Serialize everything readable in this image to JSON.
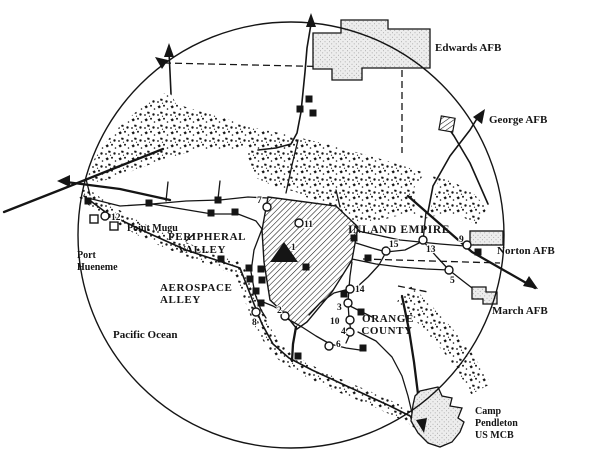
{
  "map": {
    "paper": "#ffffff",
    "ink": "#151515",
    "labels": {
      "edwards": "Edwards AFB",
      "george": "George AFB",
      "norton": "Norton AFB",
      "march": "March AFB",
      "pendleton1": "Camp",
      "pendleton2": "Pendleton",
      "pendleton3": "US MCB",
      "point_mugu": "Point Mugu",
      "port_hueneme1": "Port",
      "port_hueneme2": "Hueneme",
      "ocean": "Pacific Ocean",
      "peripheral1": "PERIPHERAL",
      "peripheral2": "VALLEY",
      "aerospace1": "AEROSPACE",
      "aerospace2": "ALLEY",
      "inland_empire": "INLAND EMPIRE",
      "orange1": "ORANGE",
      "orange2": "COUNTY"
    },
    "sites": [
      {
        "n": "1",
        "x": 284,
        "y": 253,
        "marker": "triangle",
        "lx": 291,
        "ly": 250
      },
      {
        "n": "2",
        "x": 285,
        "y": 316,
        "marker": "circle",
        "lx": 277,
        "ly": 313
      },
      {
        "n": "3",
        "x": 348,
        "y": 303,
        "marker": "circle",
        "lx": 337,
        "ly": 310
      },
      {
        "n": "4",
        "x": 350,
        "y": 332,
        "marker": "circle",
        "lx": 341,
        "ly": 334
      },
      {
        "n": "5",
        "x": 449,
        "y": 270,
        "marker": "circle",
        "lx": 450,
        "ly": 283
      },
      {
        "n": "6",
        "x": 329,
        "y": 346,
        "marker": "circle",
        "lx": 336,
        "ly": 347
      },
      {
        "n": "7",
        "x": 267,
        "y": 207,
        "marker": "circle",
        "lx": 257,
        "ly": 203
      },
      {
        "n": "8",
        "x": 256,
        "y": 312,
        "marker": "circle",
        "lx": 252,
        "ly": 325
      },
      {
        "n": "9",
        "x": 467,
        "y": 245,
        "marker": "circle",
        "lx": 459,
        "ly": 242
      },
      {
        "n": "10",
        "x": 350,
        "y": 320,
        "marker": "circle",
        "lx": 330,
        "ly": 324
      },
      {
        "n": "11",
        "x": 299,
        "y": 223,
        "marker": "circle",
        "lx": 304,
        "ly": 227
      },
      {
        "n": "12",
        "x": 105,
        "y": 216,
        "marker": "circle",
        "lx": 111,
        "ly": 220
      },
      {
        "n": "13",
        "x": 423,
        "y": 240,
        "marker": "circle",
        "lx": 426,
        "ly": 252
      },
      {
        "n": "14",
        "x": 350,
        "y": 289,
        "marker": "circle",
        "lx": 355,
        "ly": 292
      },
      {
        "n": "15",
        "x": 386,
        "y": 251,
        "marker": "circle",
        "lx": 389,
        "ly": 247
      }
    ],
    "facility_squares": [
      [
        88,
        201
      ],
      [
        149,
        203
      ],
      [
        218,
        200
      ],
      [
        211,
        213
      ],
      [
        235,
        212
      ],
      [
        221,
        259
      ],
      [
        309,
        99
      ],
      [
        300,
        109
      ],
      [
        313,
        113
      ],
      [
        249,
        268
      ],
      [
        261,
        269
      ],
      [
        250,
        279
      ],
      [
        262,
        280
      ],
      [
        256,
        291
      ],
      [
        261,
        303
      ],
      [
        306,
        267
      ],
      [
        354,
        238
      ],
      [
        368,
        258
      ],
      [
        478,
        252
      ],
      [
        344,
        294
      ],
      [
        361,
        312
      ],
      [
        298,
        356
      ],
      [
        363,
        348
      ]
    ],
    "naval_open_squares": [
      [
        94,
        219
      ],
      [
        114,
        226
      ]
    ]
  }
}
